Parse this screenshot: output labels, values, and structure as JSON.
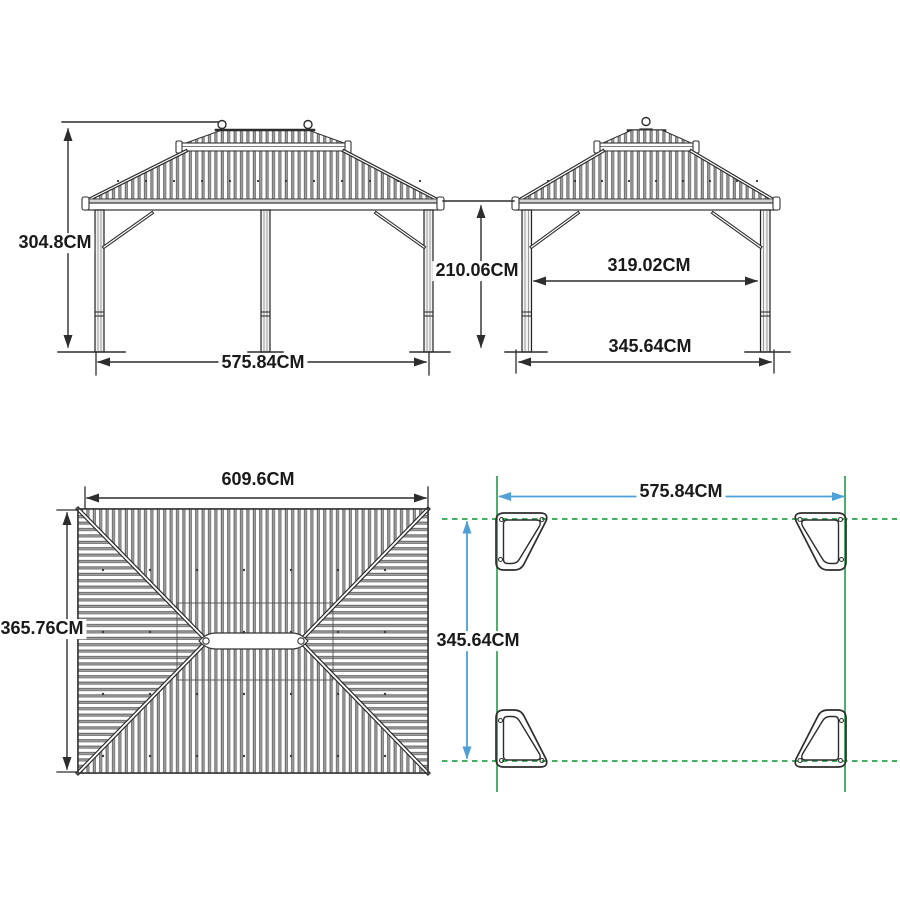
{
  "diagram_title": "gazebo-dimension-diagram",
  "unit": "CM",
  "colors": {
    "line": "#2d2d2d",
    "accent_green": "#2fa24e",
    "accent_blue": "#4f9fd8",
    "text": "#1a1a1a",
    "background": "#ffffff"
  },
  "views": {
    "front_elevation": {
      "height": "304.8CM",
      "width": "575.84CM"
    },
    "side_elevation": {
      "height": "210.06CM",
      "inner_width": "319.02CM",
      "outer_width": "345.64CM"
    },
    "roof_plan": {
      "width": "609.6CM",
      "depth": "365.76CM"
    },
    "footprint_plan": {
      "width": "575.84CM",
      "depth": "345.64CM"
    }
  }
}
